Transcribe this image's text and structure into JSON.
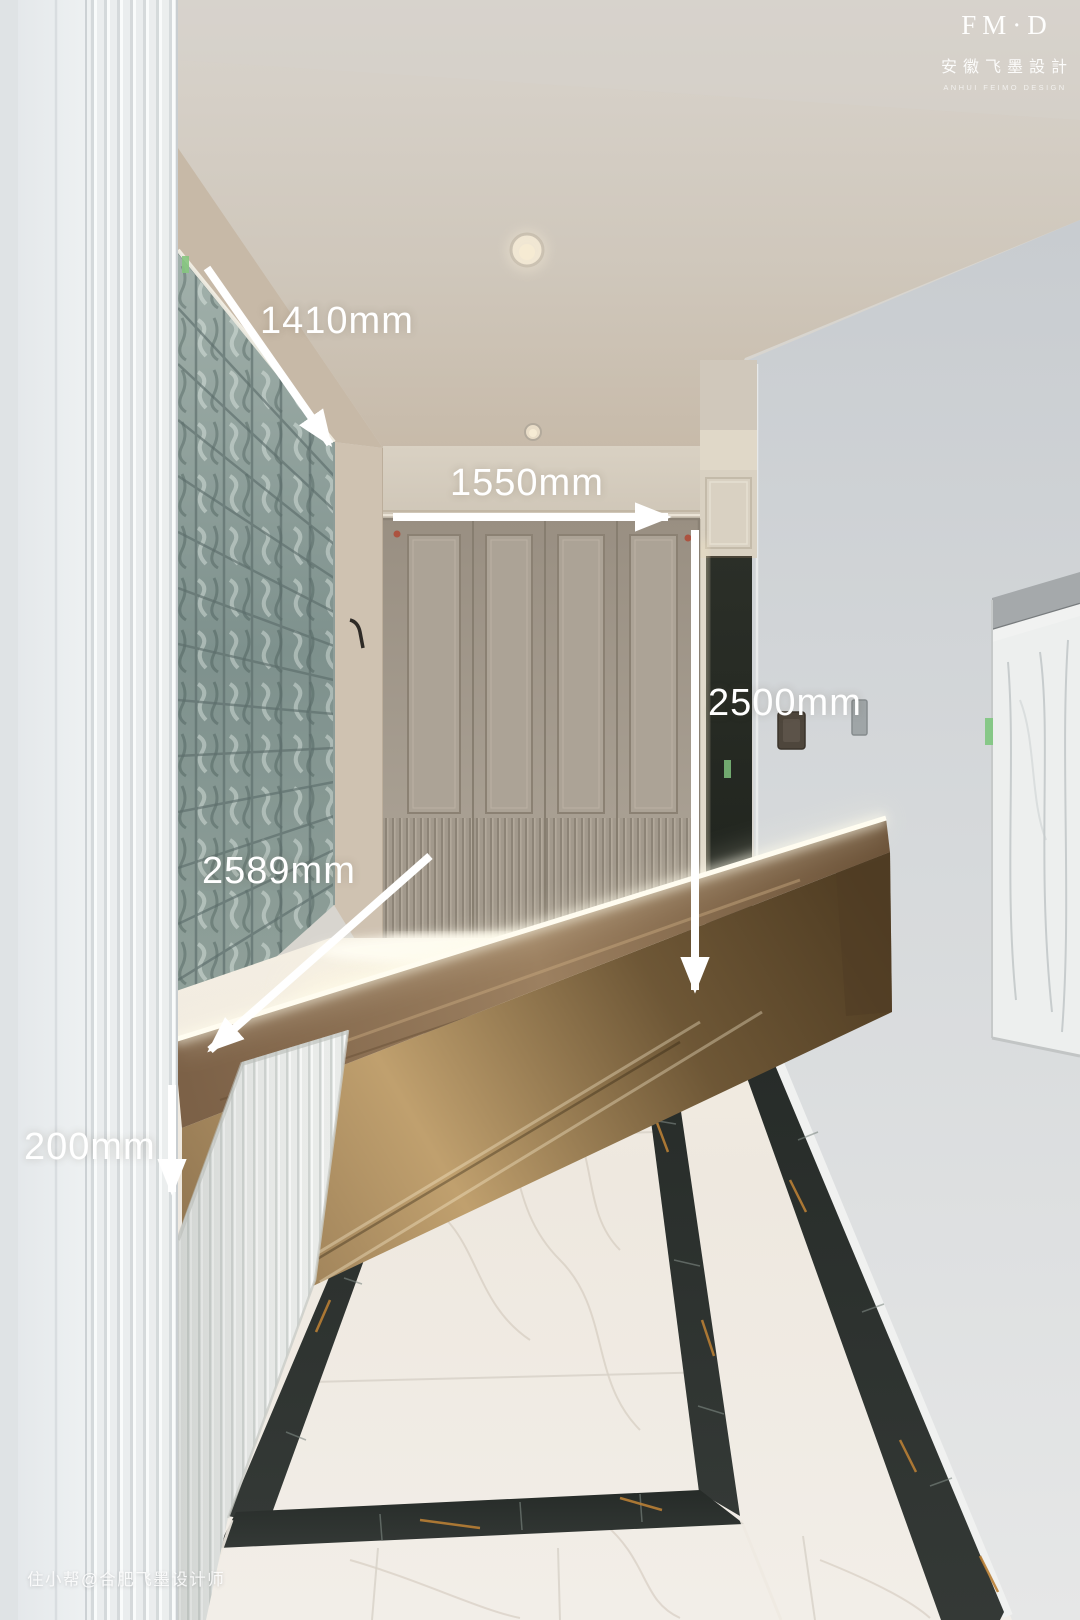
{
  "image": {
    "type": "interior-design-photo",
    "subject": "Entryway hallway with glass-block wall, cream wardrobe cabinets, floating bronze bench, dark entry door and white marble floor with dark border inlay"
  },
  "brand": {
    "logo_main": "FM·D",
    "logo_cn": "安徽飞墨設計",
    "logo_en": "ANHUI FEIMO DESIGN"
  },
  "watermark": {
    "text": "住小帮@合肥飞墨设计师"
  },
  "annotations": {
    "unit": "mm",
    "color": "#ffffff",
    "items": [
      {
        "id": "glass-wall-width",
        "label": "1410mm"
      },
      {
        "id": "wardrobe-width",
        "label": "1550mm"
      },
      {
        "id": "wardrobe-height",
        "label": "2500mm"
      },
      {
        "id": "bench-length",
        "label": "2589mm"
      },
      {
        "id": "bench-thickness",
        "label": "200mm"
      }
    ]
  },
  "palette": {
    "ceiling": "#cfc6b9",
    "left_column_white": "#eef1f2",
    "right_wall_gray": "#d5d8da",
    "cabinet_greige": "#a79e91",
    "glass_block_teal": "#84968f",
    "bench_bronze": "#8a6f4c",
    "floor_marble_white": "#f0ebe3",
    "floor_inlay_dark": "#2c312e",
    "annotation_white": "#ffffff"
  }
}
